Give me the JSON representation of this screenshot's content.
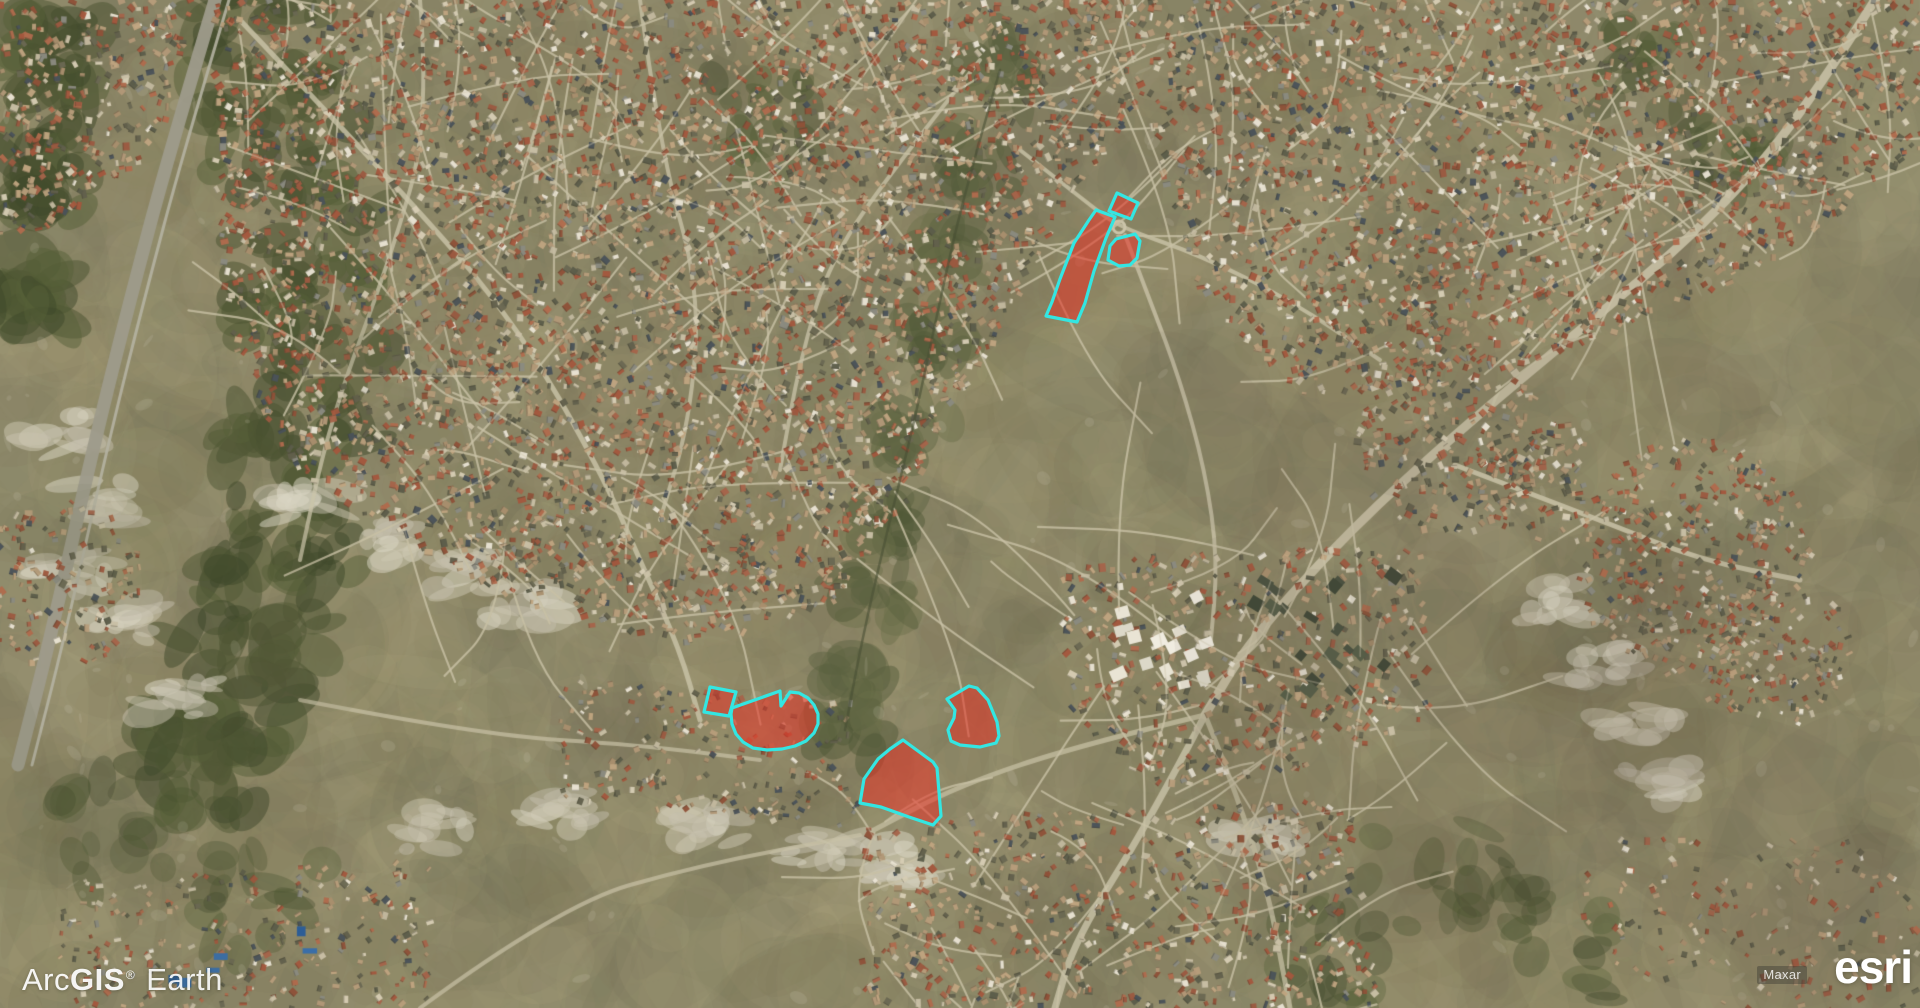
{
  "watermark": {
    "arc": "Arc",
    "gis": "GIS",
    "registered": "®",
    "earth": "Earth"
  },
  "attribution": {
    "imagery_provider": "Maxar",
    "esri_logo": "esri"
  },
  "overlay": {
    "fill_color": "#e63225",
    "fill_opacity": 0.55,
    "stroke_color": "#33e6e2",
    "stroke_width": 3.2,
    "polygons": [
      {
        "id": "north-small-quad",
        "points": [
          [
            1117,
            193
          ],
          [
            1138,
            203
          ],
          [
            1131,
            219
          ],
          [
            1109,
            211
          ]
        ]
      },
      {
        "id": "north-long-strip",
        "points": [
          [
            1096,
            210
          ],
          [
            1115,
            217
          ],
          [
            1106,
            238
          ],
          [
            1094,
            271
          ],
          [
            1085,
            303
          ],
          [
            1077,
            322
          ],
          [
            1046,
            316
          ],
          [
            1052,
            302
          ],
          [
            1060,
            279
          ],
          [
            1074,
            243
          ],
          [
            1089,
            220
          ]
        ]
      },
      {
        "id": "north-east-block",
        "points": [
          [
            1116,
            239
          ],
          [
            1135,
            234
          ],
          [
            1140,
            241
          ],
          [
            1137,
            258
          ],
          [
            1130,
            265
          ],
          [
            1119,
            266
          ],
          [
            1108,
            260
          ],
          [
            1110,
            246
          ]
        ]
      },
      {
        "id": "west-square",
        "points": [
          [
            710,
            687
          ],
          [
            736,
            692
          ],
          [
            729,
            716
          ],
          [
            704,
            712
          ]
        ]
      },
      {
        "id": "west-boot",
        "points": [
          [
            732,
            708
          ],
          [
            780,
            691
          ],
          [
            781,
            706
          ],
          [
            790,
            692
          ],
          [
            799,
            693
          ],
          [
            808,
            698
          ],
          [
            814,
            705
          ],
          [
            818,
            714
          ],
          [
            818,
            724
          ],
          [
            814,
            733
          ],
          [
            806,
            741
          ],
          [
            795,
            746
          ],
          [
            782,
            749
          ],
          [
            767,
            750
          ],
          [
            753,
            748
          ],
          [
            743,
            742
          ],
          [
            736,
            734
          ],
          [
            732,
            724
          ],
          [
            731,
            714
          ]
        ]
      },
      {
        "id": "south-fan",
        "points": [
          [
            903,
            740
          ],
          [
            933,
            762
          ],
          [
            937,
            768
          ],
          [
            941,
            816
          ],
          [
            933,
            825
          ],
          [
            909,
            817
          ],
          [
            881,
            807
          ],
          [
            860,
            803
          ],
          [
            864,
            779
          ],
          [
            878,
            759
          ],
          [
            890,
            749
          ]
        ]
      },
      {
        "id": "east-blob",
        "points": [
          [
            947,
            699
          ],
          [
            969,
            686
          ],
          [
            977,
            688
          ],
          [
            988,
            700
          ],
          [
            997,
            722
          ],
          [
            999,
            736
          ],
          [
            996,
            743
          ],
          [
            980,
            747
          ],
          [
            960,
            745
          ],
          [
            951,
            741
          ],
          [
            948,
            730
          ],
          [
            954,
            718
          ],
          [
            955,
            710
          ],
          [
            950,
            703
          ]
        ]
      }
    ]
  }
}
